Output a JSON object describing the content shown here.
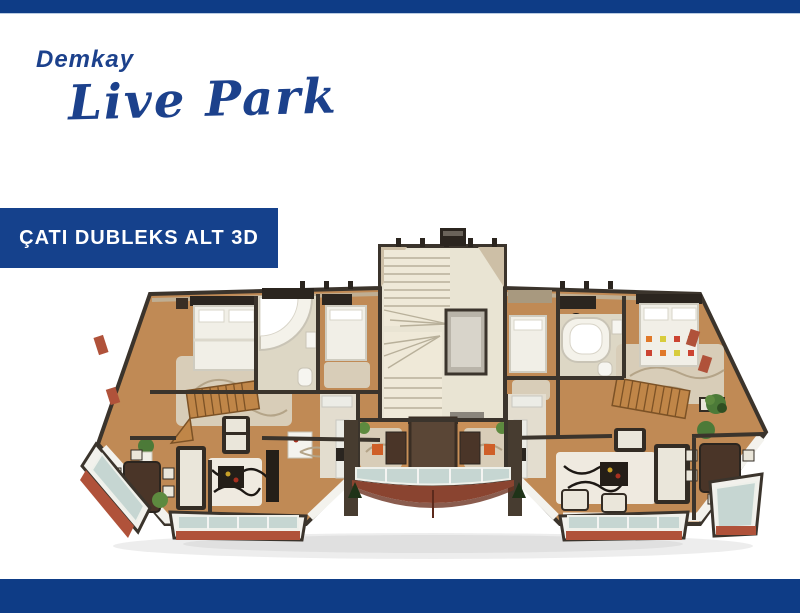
{
  "header": {
    "top_bar_color": "#0e3c86"
  },
  "logo": {
    "brand": "Demkay",
    "name": "Live Park",
    "color": "#1c418c"
  },
  "banner": {
    "label": "ÇATI DUBLEKS ALT 3D",
    "background": "#15418c",
    "text_color": "#ffffff"
  },
  "floor_plan": {
    "description": "3D aerial cutaway render of the roof duplex lower floor: central winder stairwell with elevator, two mirrored apartments with bedrooms, corner-tub bathrooms, living and dining rooms, kitchens, internal wooden duplex stairs, glass-railed balconies and a curved center balcony",
    "palette": {
      "walls": "#3b342c",
      "wood_floor": "#c08a55",
      "stair_floor": "#e9e4d3",
      "bath_floor": "#ddd7c5",
      "rug": "#d8cdb8",
      "glass": "#c6d6d2",
      "terracotta": "#b0523a",
      "curved_balcony_floor": "#8a4430"
    }
  },
  "footer": {
    "bottom_bar_color": "#0e3c86"
  }
}
